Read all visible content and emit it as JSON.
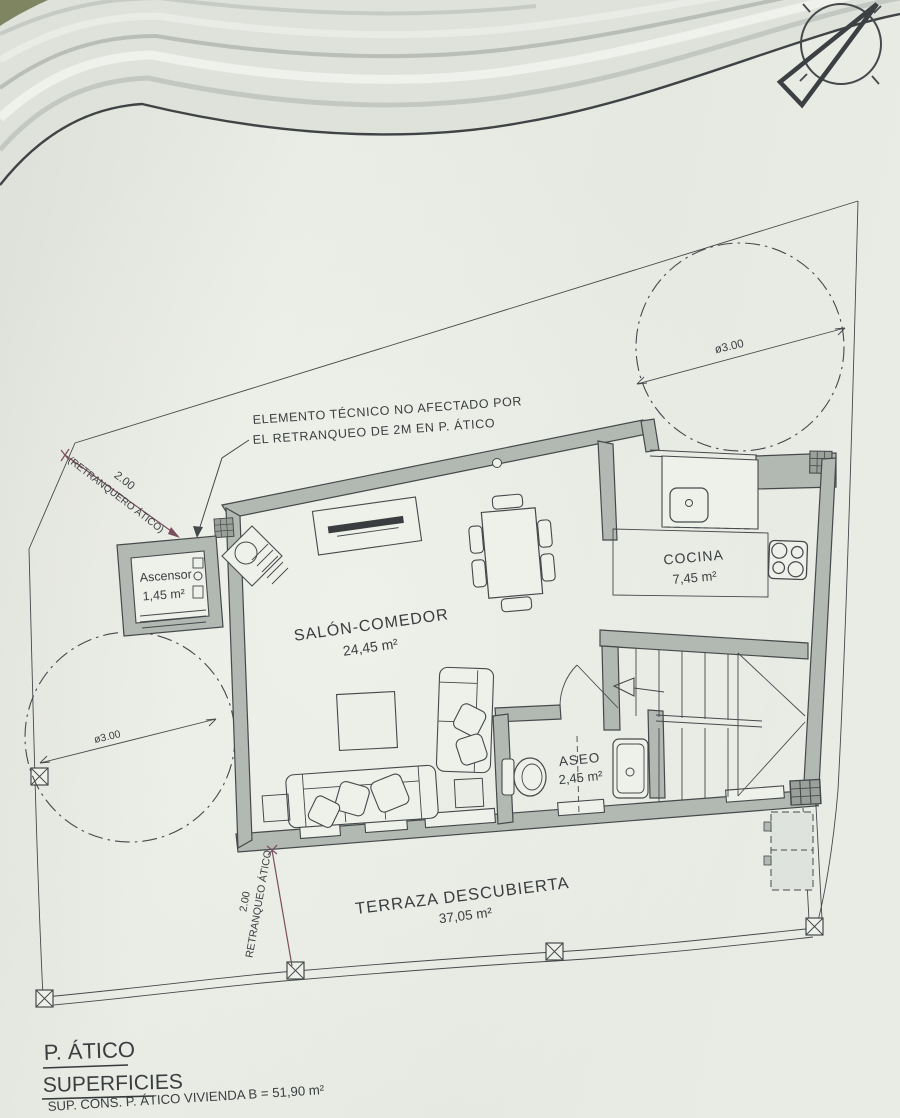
{
  "callout": {
    "line1": "ELEMENTO TÉCNICO NO AFECTADO POR",
    "line2": "EL RETRANQUEO DE 2M EN P. ÁTICO"
  },
  "rooms": {
    "ascensor": {
      "name": "Ascensor",
      "area": "1,45 m²"
    },
    "salon_comedor": {
      "name": "SALÓN-COMEDOR",
      "area": "24,45 m²"
    },
    "cocina": {
      "name": "COCINA",
      "area": "7,45 m²"
    },
    "aseo": {
      "name": "ASEO",
      "area": "2,45 m²"
    },
    "terraza": {
      "name": "TERRAZA DESCUBIERTA",
      "area": "37,05 m²"
    }
  },
  "dimensions": {
    "setback_top": {
      "value": "2.00",
      "note": "(RETRANQUERO ÁTICO)"
    },
    "setback_bottom": {
      "value": "2.00",
      "note": "RETRANQUEO ÁTICO"
    },
    "circle_right_diameter": "ø3.00",
    "circle_left_diameter": "ø3.00"
  },
  "title_block": {
    "floor": "P. ÁTICO",
    "heading": "SUPERFICIES",
    "surface_line": "SUP. CONS. P. ÁTICO VIVIENDA B =  51,90 m²"
  },
  "colors": {
    "paper": "#e7eae3",
    "paper_light": "#eef0ea",
    "ink": "#3a3e40",
    "line": "#45494b",
    "wall_fill": "#b2b8b2",
    "wall_dark": "#9aa19b",
    "dim": "#7a4f5f"
  }
}
